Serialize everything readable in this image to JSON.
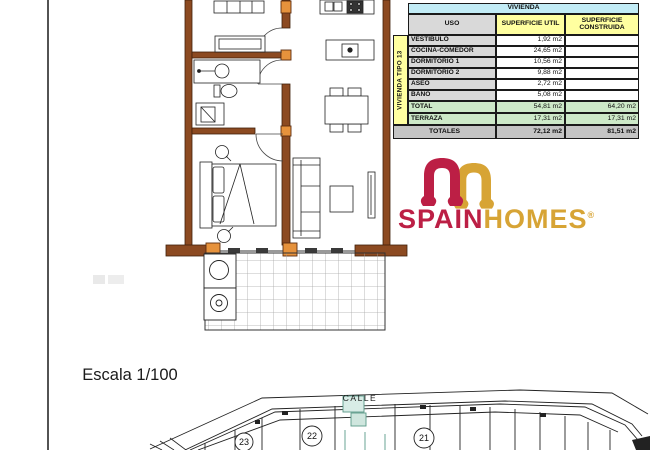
{
  "table": {
    "title": "VIVIENDA",
    "col_uso": "USO",
    "col_util": "SUPERFICIE UTIL",
    "col_construida": "SUPERFICIE CONSTRUIDA",
    "strip_label": "VIVIENDA TIPO 13",
    "rows": [
      {
        "uso": "VESTIBULO",
        "util": "1,92 m2",
        "construida": ""
      },
      {
        "uso": "COCINA-COMEDOR",
        "util": "24,65 m2",
        "construida": ""
      },
      {
        "uso": "DORMITORIO 1",
        "util": "10,56 m2",
        "construida": ""
      },
      {
        "uso": "DORMITORIO 2",
        "util": "9,88 m2",
        "construida": ""
      },
      {
        "uso": "ASEO",
        "util": "2,72 m2",
        "construida": ""
      },
      {
        "uso": "BAÑO",
        "util": "5,08 m2",
        "construida": ""
      }
    ],
    "total": {
      "label": "TOTAL",
      "util": "54,81 m2",
      "construida": "64,20 m2"
    },
    "terraza": {
      "label": "TERRAZA",
      "util": "17,31 m2",
      "construida": "17,31 m2"
    },
    "totales": {
      "label": "TOTALES",
      "util": "72,12 m2",
      "construida": "81,51 m2"
    }
  },
  "logo": {
    "brand_part1": "SPAIN",
    "brand_part2": "HOMES",
    "registered": "®",
    "color_red": "#bc1f45",
    "color_gold": "#d7a435"
  },
  "scale_label": "Escala 1/100",
  "site_plan": {
    "street_label": "CALLE",
    "unit_numbers": [
      "23",
      "22",
      "21"
    ]
  },
  "colors": {
    "wall_brown": "#8c4a21",
    "pillar_orange": "#e6923c",
    "table_cyan": "#c2ecf6",
    "table_yellow": "#ffffa0",
    "table_green": "#cde9c8",
    "teal_highlight": "#5a9a88"
  }
}
